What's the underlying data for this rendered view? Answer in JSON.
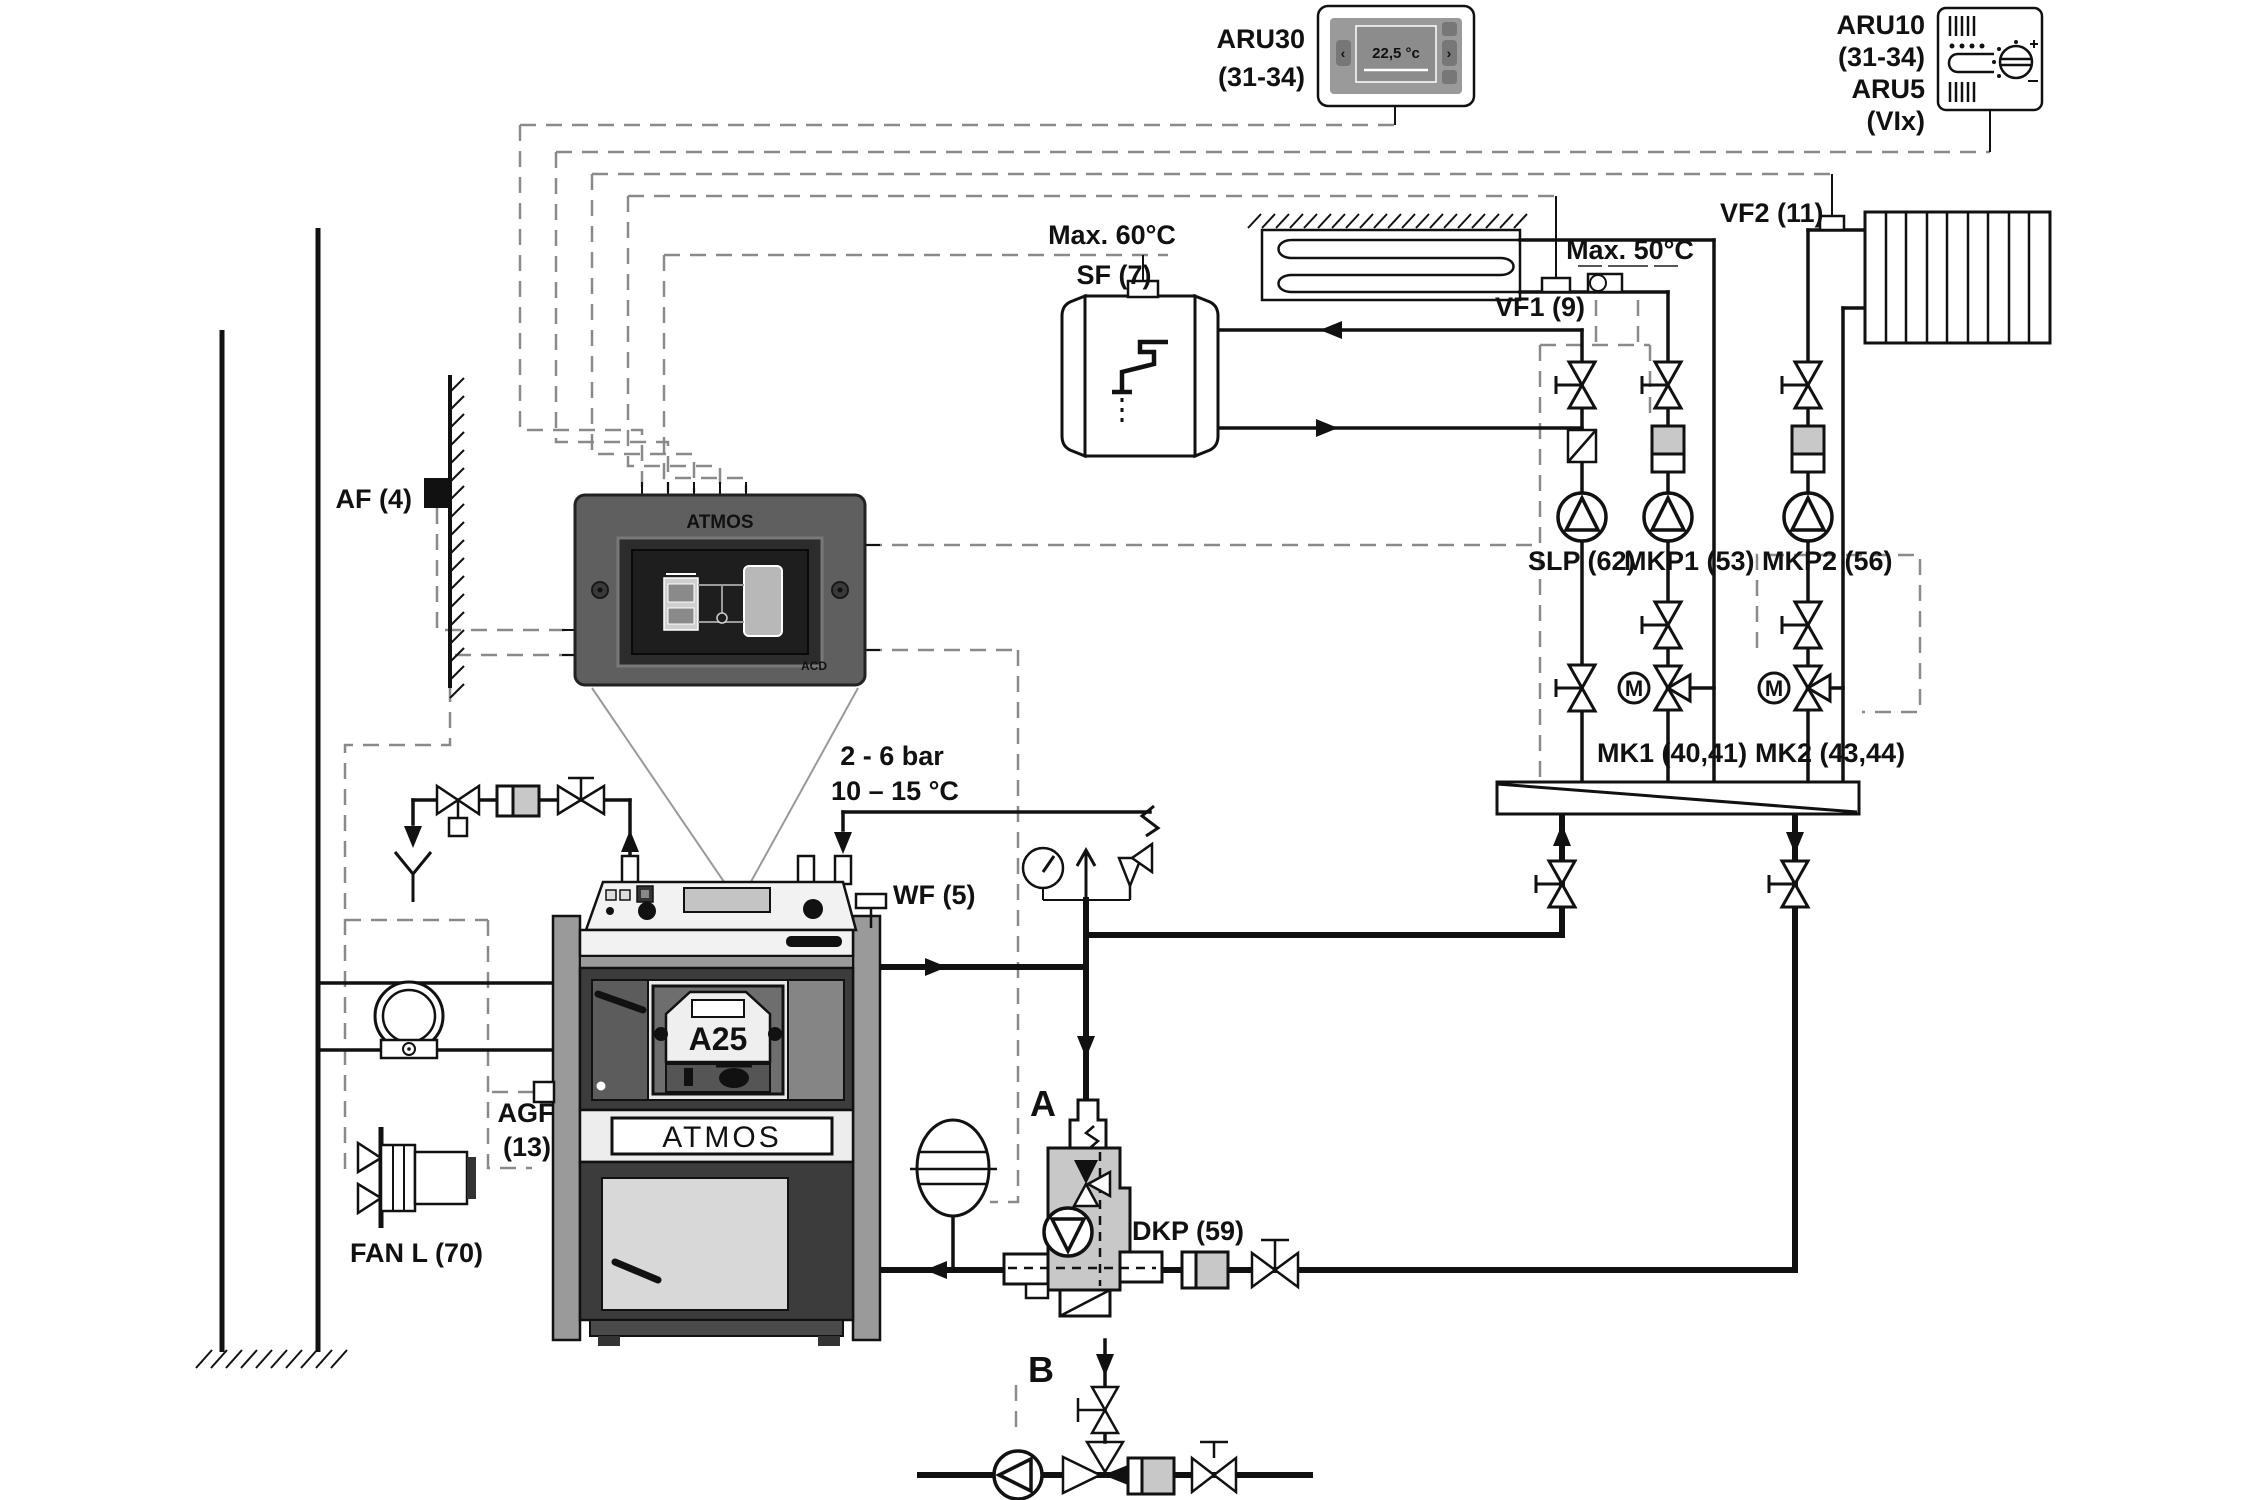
{
  "colors": {
    "line": "#111111",
    "cable_gray": "#8a8a8a",
    "panel_dark": "#5f5f5f",
    "boiler_light": "#ededed",
    "boiler_dark": "#3c3c3c",
    "metal_gray": "#9a9a9a",
    "component_gray": "#c8c8c8",
    "screen_black": "#1e1e1e"
  },
  "devices": {
    "aru30": {
      "name": "ARU30",
      "range": "(31-34)",
      "display_temp": "22,5 °c"
    },
    "aru10": {
      "name": "ARU10",
      "range": "(31-34)",
      "alt_name": "ARU5",
      "alt_range": "(VIx)"
    }
  },
  "sensors": {
    "af": "AF (4)",
    "sf": "SF (7)",
    "vf1": "VF1 (9)",
    "vf2": "VF2 (11)",
    "wf": "WF (5)",
    "agf_line1": "AGF",
    "agf_line2": "(13)"
  },
  "limits": {
    "max60": "Max. 60°C",
    "max50": "Max. 50°C",
    "pressure": "2 - 6 bar",
    "temp": "10 – 15 °C"
  },
  "pumps": {
    "slp": "SLP (62)",
    "mkp1": "MKP1 (53)",
    "mkp2": "MKP2 (56)",
    "dkp": "DKP (59)",
    "fan": "FAN L (70)"
  },
  "valves": {
    "mk1": "MK1 (40,41)",
    "mk2": "MK2 (43,44)",
    "motor": "M"
  },
  "boiler": {
    "brand": "ATMOS",
    "burner": "A25",
    "panel_brand": "ATMOS",
    "panel_model": "ACD"
  },
  "variants": {
    "a": "A",
    "b": "B"
  }
}
